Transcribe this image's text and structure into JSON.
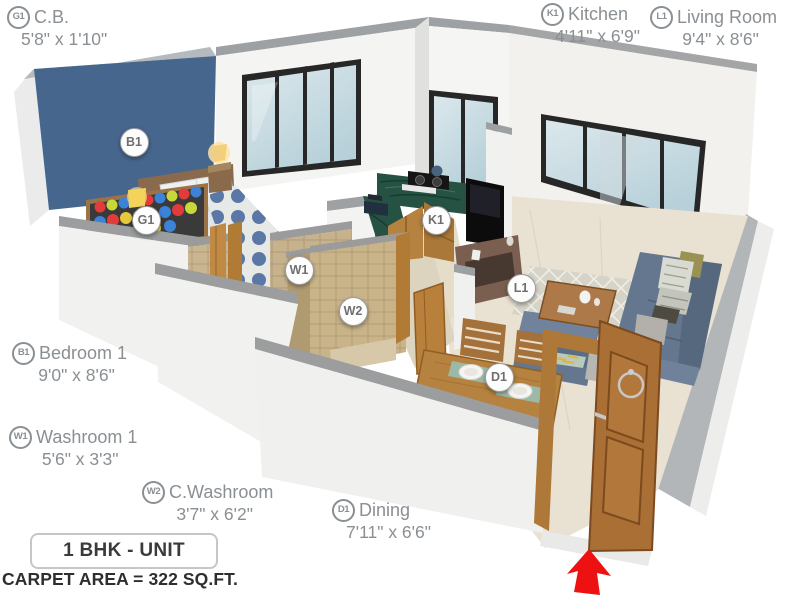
{
  "title_box": {
    "label": "1 BHK - UNIT"
  },
  "carpet_area": "CARPET AREA = 322 SQ.FT.",
  "labels": [
    {
      "id": "G1",
      "name": "C.B.",
      "dims": "5'8\" x 1'10\""
    },
    {
      "id": "K1",
      "name": "Kitchen",
      "dims": "4'11\" x 6'9\""
    },
    {
      "id": "L1",
      "name": "Living Room",
      "dims": "9'4\" x 8'6\""
    },
    {
      "id": "B1",
      "name": "Bedroom 1",
      "dims": "9'0\" x 8'6\""
    },
    {
      "id": "W1",
      "name": "Washroom 1",
      "dims": "5'6\" x 3'3\""
    },
    {
      "id": "W2",
      "name": "C.Washroom",
      "dims": "3'7\" x 6'2\""
    },
    {
      "id": "D1",
      "name": "Dining",
      "dims": "7'11\" x 6'6\""
    }
  ],
  "plan": {
    "markers": [
      {
        "id": "B1"
      },
      {
        "id": "G1"
      },
      {
        "id": "W1"
      },
      {
        "id": "W2"
      },
      {
        "id": "K1"
      },
      {
        "id": "L1"
      },
      {
        "id": "D1"
      }
    ]
  },
  "colors": {
    "accent_wall": "#47668e",
    "entrance_arrow": "#ee1111",
    "label_text": "#8a8f93",
    "counter_granite": "#265243",
    "sofa": "#64778f"
  }
}
